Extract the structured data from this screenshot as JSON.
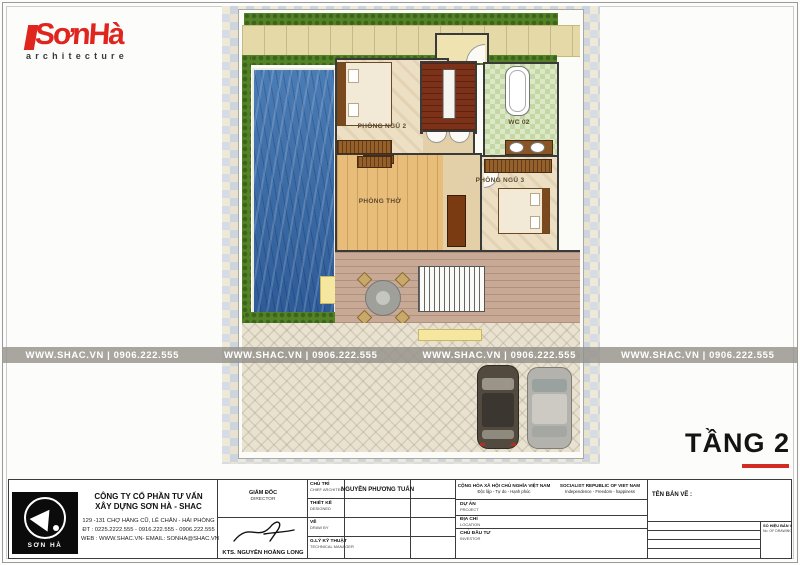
{
  "brand": {
    "logo_text": "SơnHà",
    "logo_sub": "architecture",
    "accent_color": "#e0251f"
  },
  "watermark": {
    "display": "WWW.SHAC.VN   |   0906.222.555",
    "site": "WWW.SHAC.VN",
    "phone": "0906.222.555"
  },
  "plan": {
    "rooms": [
      {
        "label": "PHÒNG NGỦ 2"
      },
      {
        "label": "WC 02"
      },
      {
        "label": "PHÒNG THỜ"
      },
      {
        "label": "PHÒNG NGỦ 3"
      }
    ]
  },
  "floor_label": {
    "text": "TẦNG 2"
  },
  "title_block": {
    "company": {
      "name_line1": "CÔNG TY CỔ PHẦN TƯ VẤN",
      "name_line2": "XÂY DỰNG SƠN HÀ - SHAC",
      "address": "129 -131 CHỢ HÀNG CŨ, LÊ CHÂN - HẢI PHÒNG",
      "phone": "ĐT : 0225.2222.555 - 0916.222.555 - 0906.222.555",
      "web": "WEB : WWW.SHAC.VN- EMAIL: SONHA@SHAC.VN",
      "logo_caption": "SƠN HÀ"
    },
    "director": {
      "label_vi": "GIÁM ĐỐC",
      "label_en": "DIRECTOR",
      "name": "KTS. NGUYỄN HOÀNG LONG"
    },
    "roles": [
      {
        "vi": "CHỦ TRÌ",
        "en": "CHIEF ARCHITECT",
        "value": "NGUYỄN PHƯƠNG TUẤN"
      },
      {
        "vi": "THIẾT KẾ",
        "en": "DESIGNED",
        "value": ""
      },
      {
        "vi": "VẼ",
        "en": "DRAW BY",
        "value": ""
      },
      {
        "vi": "G.LÝ KỸ THUẬT",
        "en": "TECHNICAL MANAGER",
        "value": ""
      }
    ],
    "republic": {
      "vi": "CỘNG HÒA XÃ HỘI CHỦ NGHĨA VIỆT NAM",
      "vi_sub": "Độc lập - Tự do - Hạnh phúc",
      "en": "SOCIALIST REPUBLIC OF VIET NAM",
      "en_sub": "Independence - Freedom - happiness"
    },
    "project_rows": [
      {
        "vi": "DỰ ÁN",
        "en": "PROJECT"
      },
      {
        "vi": "ĐỊA CHỈ",
        "en": "LOCATION"
      },
      {
        "vi": "CHỦ ĐẦU TƯ",
        "en": "INVESTOR"
      }
    ],
    "drawing": {
      "title_label": "TÊN BẢN VẼ :",
      "rows": [
        {
          "vi": "HẠNG MỤC",
          "en": "CATEGORIES"
        },
        {
          "vi": "GIAI ĐOẠN THIẾT KẾ",
          "en": "DESIGN PHASE"
        },
        {
          "vi": "TỈ LỆ",
          "en": "SCALE"
        },
        {
          "vi": "HOÀN THÀNH",
          "en": "DATE"
        }
      ],
      "number_vi": "SỐ HIỆU BẢN VẼ",
      "number_en": "No. OF DRAWING"
    }
  }
}
